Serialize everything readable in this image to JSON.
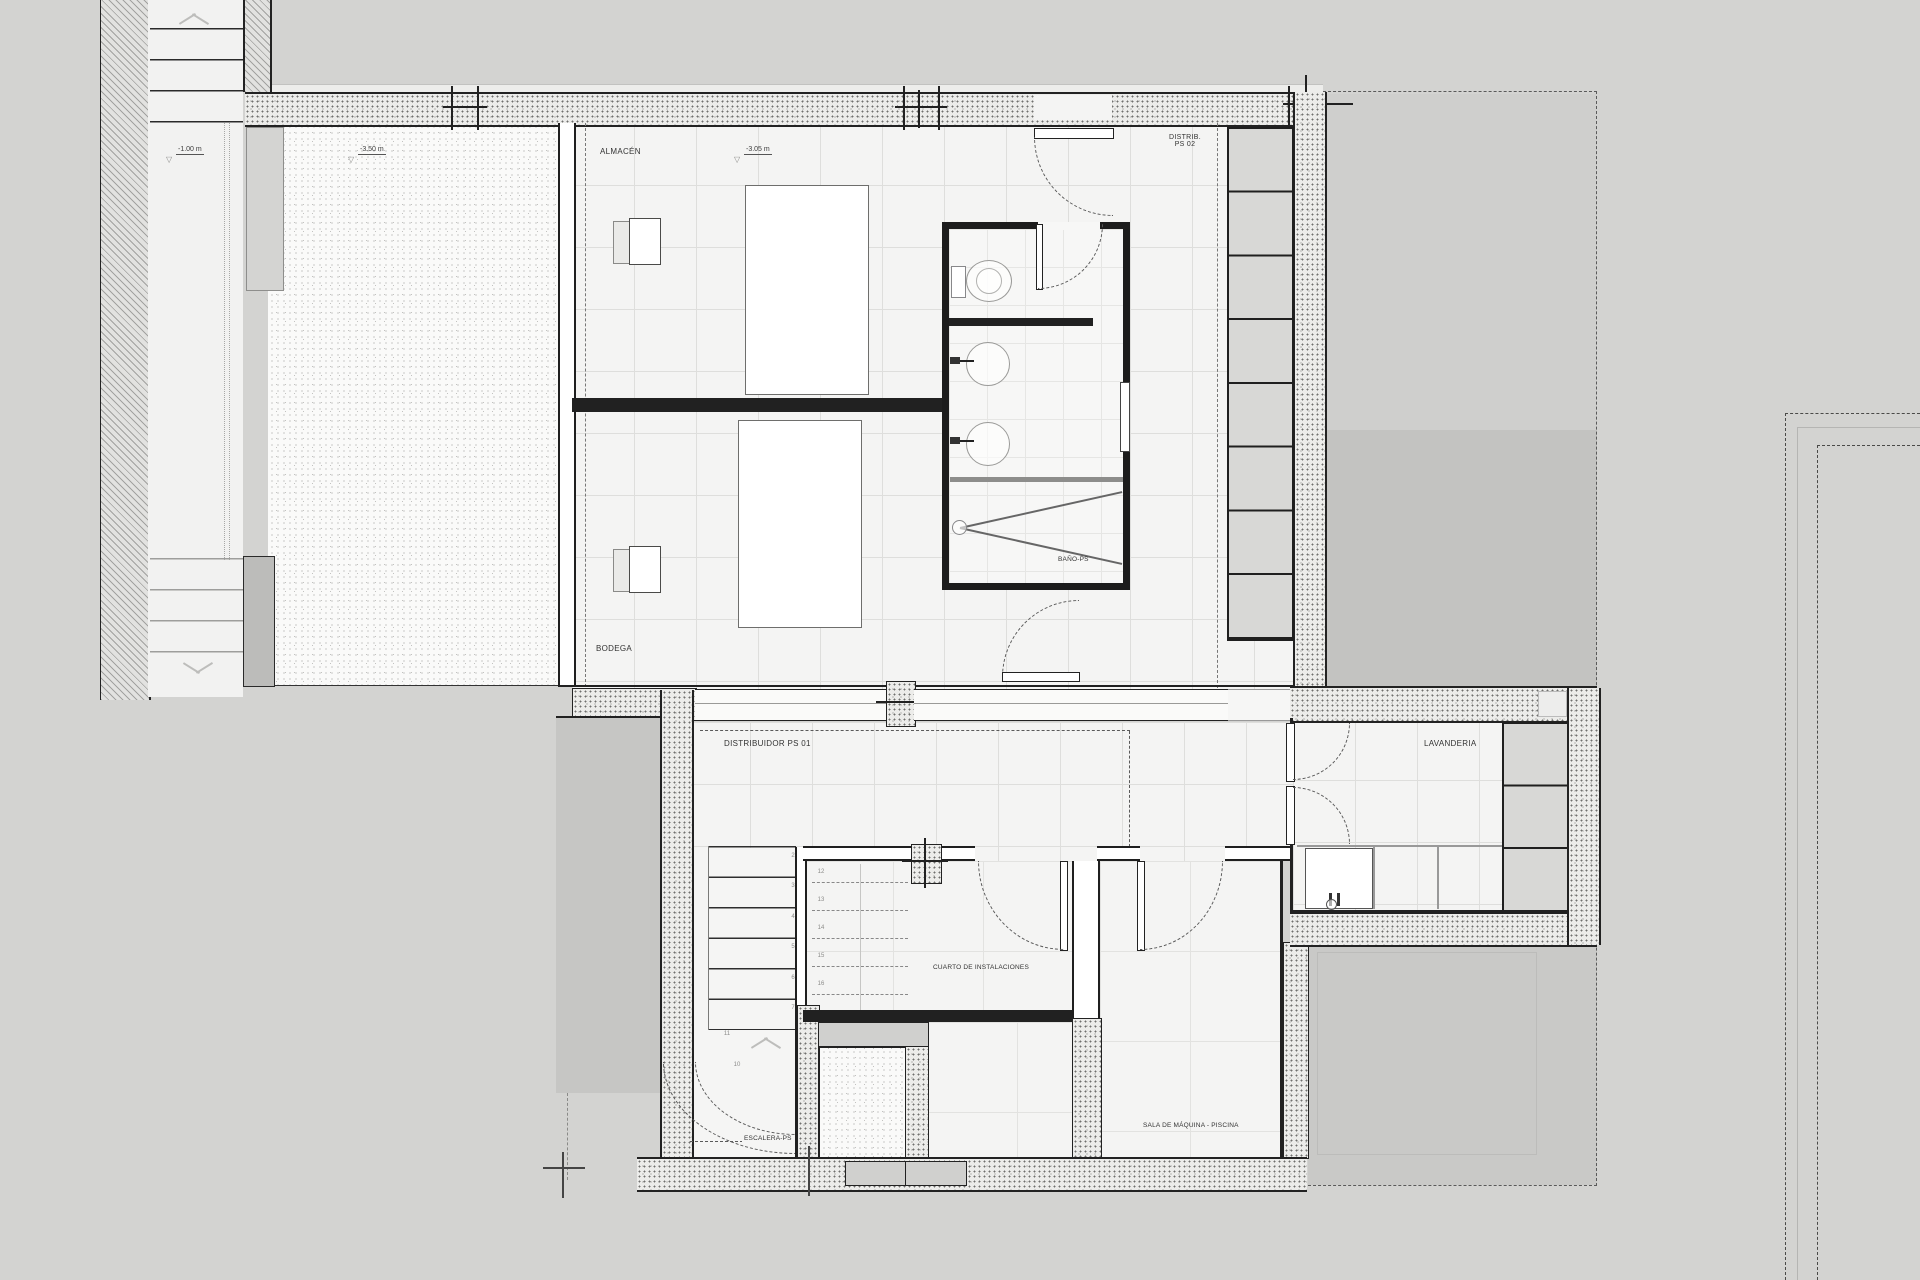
{
  "colors": {
    "paper": "#d3d3d1",
    "wall": "#1f1f1f",
    "floor": "#f4f4f3",
    "terrace": "#c3c3c1",
    "furniture_fill": "#d8d8d6"
  },
  "labels": {
    "level_outside": "-1.00 m",
    "level_patio": "-3.50 m",
    "level_almacen": "-3.05 m",
    "almacen": "ALMACÉN",
    "bodega": "BODEGA",
    "bano": "BAÑO-PS",
    "distrib_ps02_l1": "DISTRIB.",
    "distrib_ps02_l2": "PS 02",
    "distribuidor_ps01": "DISTRIBUIDOR PS 01",
    "lavanderia": "LAVANDERIA",
    "cuarto": "CUARTO DE INSTALACIONES",
    "escalera": "ESCALERA-PS",
    "sala": "SALA DE MÁQUINA - PISCINA"
  },
  "stair_numbers": {
    "lower_flight": [
      "2",
      "3",
      "4",
      "5",
      "6",
      "7"
    ],
    "turn_upper": "11",
    "turn_lower": "10",
    "upper_flight_dashed": [
      "12",
      "13",
      "14",
      "15",
      "16"
    ]
  }
}
